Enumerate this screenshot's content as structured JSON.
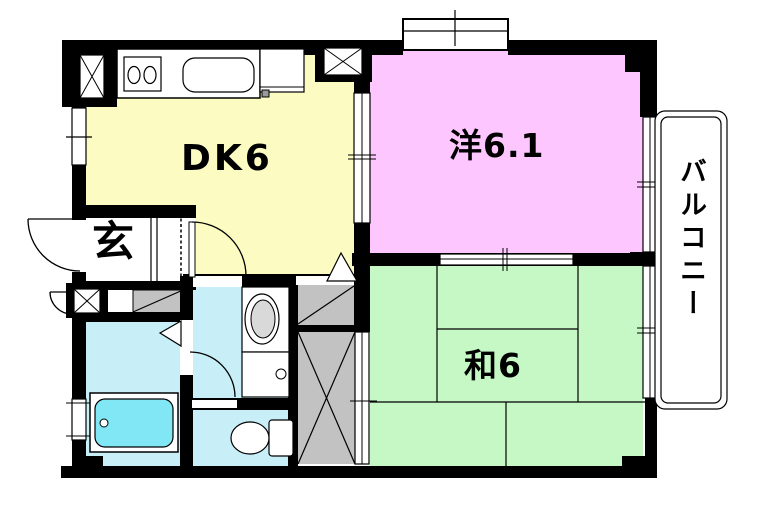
{
  "plan": {
    "type": "apartment-floor-plan",
    "rooms": {
      "dining_kitchen": {
        "label": "DK6"
      },
      "western_room": {
        "label": "洋6.1"
      },
      "japanese_room": {
        "label": "和6"
      },
      "entrance": {
        "label": "玄"
      },
      "balcony": {
        "label": "バルコニー"
      }
    },
    "fixtures": [
      "kitchen-counter",
      "stove-burners",
      "kitchen-sink",
      "bathtub",
      "wash-basin",
      "washing-machine-pan",
      "toilet",
      "closet-small",
      "closet-large",
      "shoe-cabinet",
      "entrance-door",
      "meter-box-door",
      "room-doors",
      "sliding-doors",
      "windows"
    ],
    "colors": {
      "dk_floor": "#FCFCC2",
      "western_floor": "#FEC6FE",
      "japanese_floor": "#C6F8C6",
      "wet_area_floor": "#C8EFF8",
      "bathtub_water": "#82E7F5",
      "closet_gray": "#C2C2C2",
      "wall": "#000000",
      "background": "#FFFFFF"
    }
  }
}
